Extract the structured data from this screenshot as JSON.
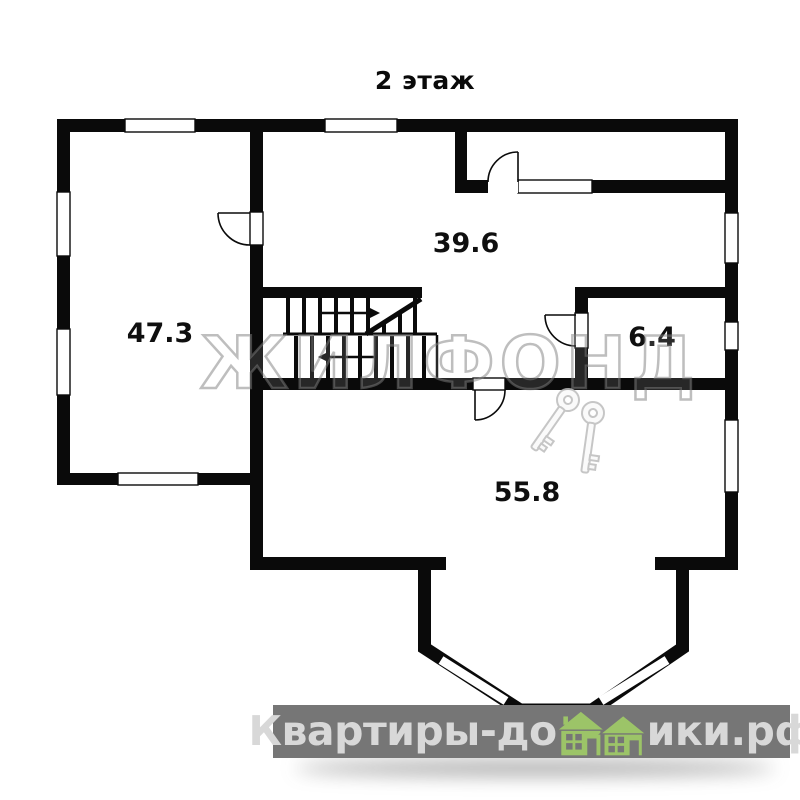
{
  "plan": {
    "title": "2 этаж",
    "type": "floor-plan",
    "floor_number": 2
  },
  "rooms": [
    {
      "id": "room-47-3",
      "area": "47.3",
      "position": "left"
    },
    {
      "id": "room-39-6",
      "area": "39.6",
      "position": "top-center"
    },
    {
      "id": "room-6-4",
      "area": "6.4",
      "position": "middle-right"
    },
    {
      "id": "room-55-8",
      "area": "55.8",
      "position": "bottom-center"
    }
  ],
  "features": {
    "staircase": "u-shaped switchback stair with up/down arrows",
    "bay_window": "polygonal bay at bottom center with three windows",
    "doors": 4,
    "windows_outer": 8
  },
  "watermark": {
    "brand": "ЖИЛФОНД",
    "keys_icon": "two-crossed-keys"
  },
  "footer": {
    "brand_left": "Квартиры-до",
    "brand_right": "ики.рф",
    "full_text": "Квартиры-домики.рф",
    "house_icon": "two-green-houses"
  },
  "colors": {
    "wall": "#0a0a0a",
    "background": "#ffffff",
    "footer_bar": "#767676",
    "footer_text": "#d8d8d8",
    "house_green": "#9cc468"
  }
}
